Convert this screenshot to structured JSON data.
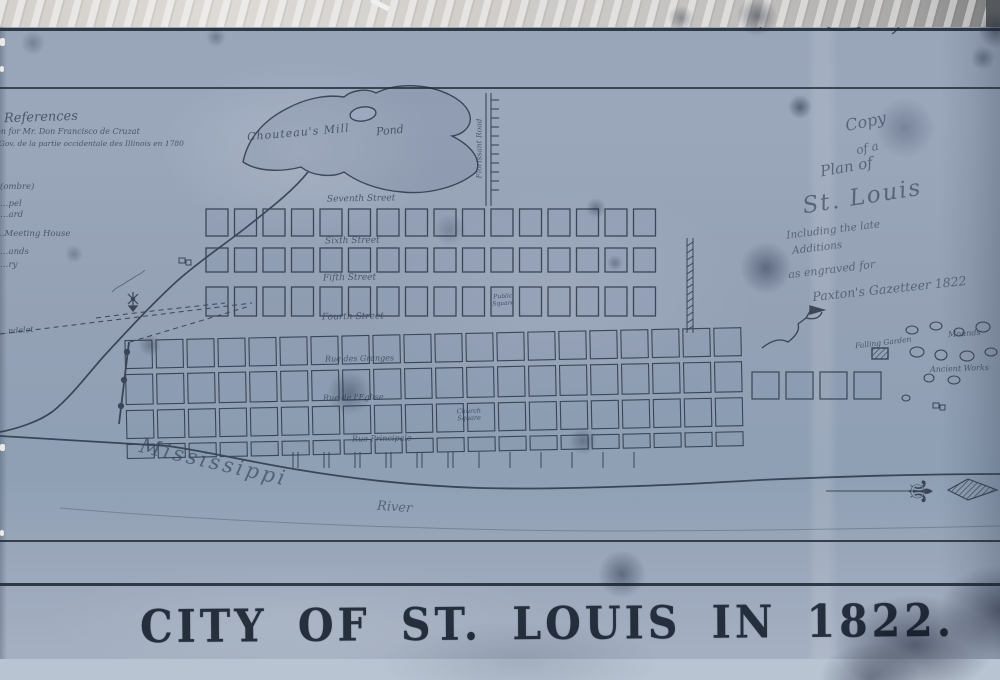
{
  "annotations": {
    "chief_clerk": "Chief Clk"
  },
  "cartouche": {
    "line1": "Copy",
    "line2": "of a",
    "line3": "Plan of",
    "line4": "St. Louis",
    "line5": "Including the late",
    "line6": "Additions",
    "line7": "as engraved for",
    "line8": "Paxton's Gazetteer 1822"
  },
  "references": {
    "heading": "References",
    "note1": "…on for Mr. Don Francisco de Cruzat",
    "note2": "…t Gov. de la partie occidentale des Illinois en 1780",
    "items": [
      {
        "label": "(ombre)"
      },
      {
        "label": "…pel"
      },
      {
        "label": "…ard"
      },
      {
        "label": "…Meeting House"
      },
      {
        "label": "…ands"
      },
      {
        "label": "…ry"
      }
    ]
  },
  "map": {
    "pond_label_1": "Chouteau's Mill",
    "pond_label_2": "Pond",
    "streets": [
      {
        "label": "Seventh Street"
      },
      {
        "label": "Sixth Street"
      },
      {
        "label": "Fifth Street"
      },
      {
        "label": "Fourth Street"
      },
      {
        "label": "Rue des Granges"
      },
      {
        "label": "Rue de l'Eglise"
      },
      {
        "label": "Rue Principale"
      }
    ],
    "public_square_1": "Public",
    "public_square_2": "Square",
    "church_square_1": "Church",
    "church_square_2": "Square",
    "florissant_road": "Florissant Road",
    "road_fragment": "…ndelet",
    "falling_garden": "Falling Garden",
    "mounds": "Mounds",
    "ancient_works": "Ancient Works",
    "river_1": "Mississippi",
    "river_2": "River"
  },
  "footer": {
    "title": "CITY OF ST. LOUIS IN 1822."
  },
  "colors": {
    "paper_blue": "#94a1b5",
    "ink": "#2b3646",
    "light_strip": "#b9c4d3",
    "torn_strip": "#d6d3cf"
  }
}
